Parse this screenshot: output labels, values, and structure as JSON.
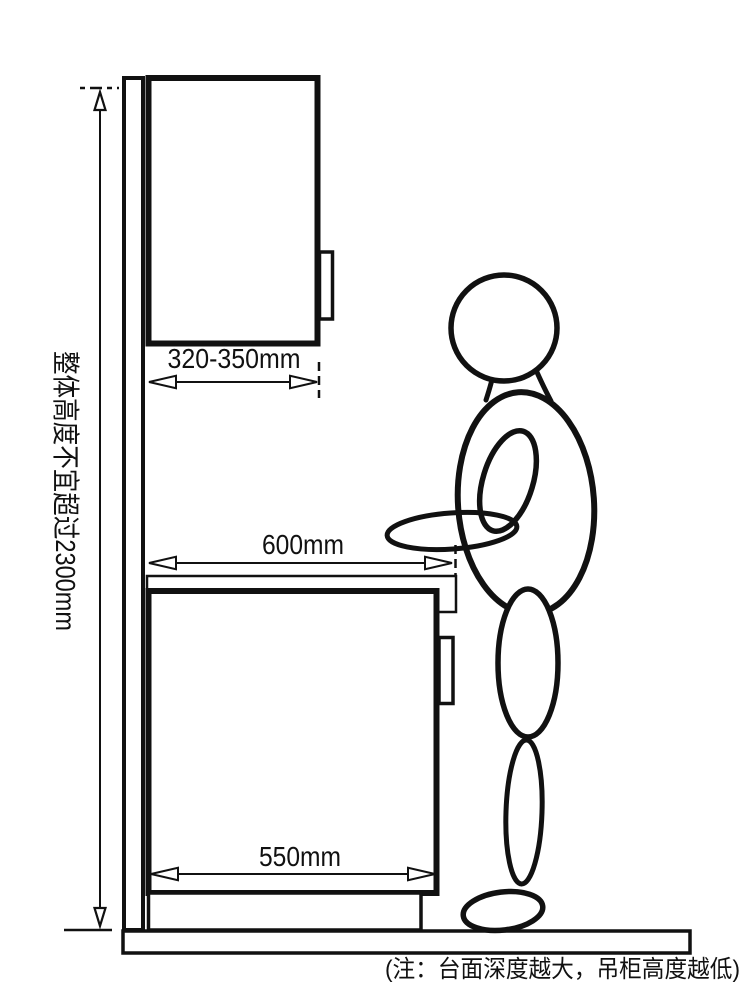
{
  "diagram": {
    "type": "kitchen-cabinet-ergonomics-diagram",
    "ink_color": "#111111",
    "background_color": "#ffffff",
    "labels": {
      "overall_height": "整体高度不宜超过2300mm",
      "wall_cabinet_depth": "320-350mm",
      "counter_total_depth": "600mm",
      "base_cabinet_depth": "550mm"
    },
    "note": "(注：台面深度越大，吊柜高度越低)"
  }
}
